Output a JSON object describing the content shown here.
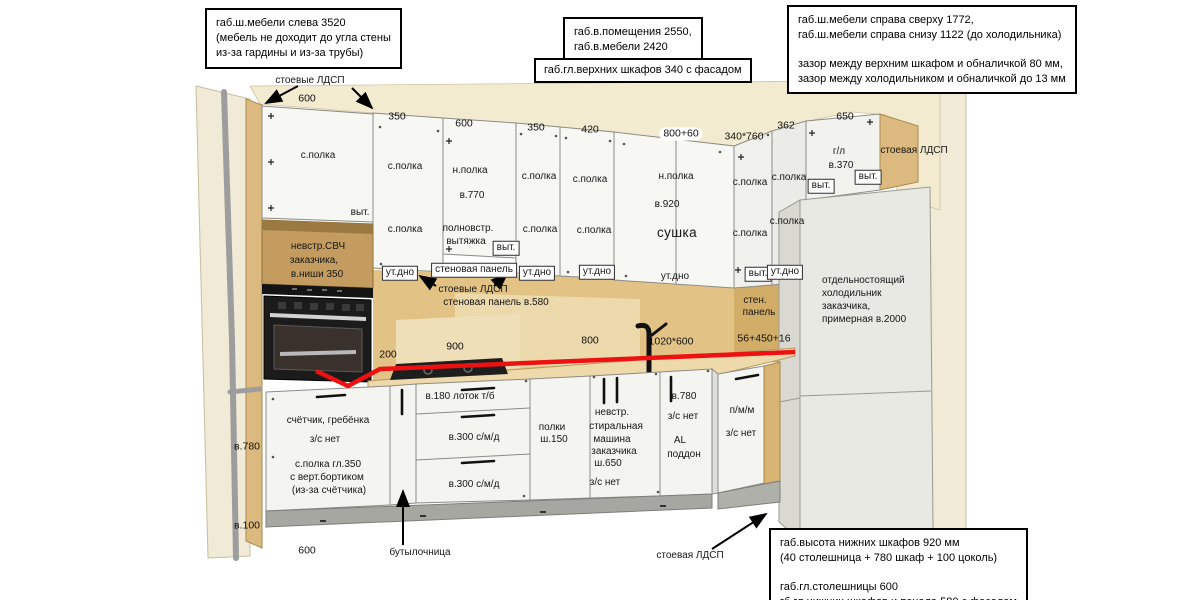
{
  "callouts": {
    "top_left": {
      "lines": [
        "габ.ш.мебели слева 3520",
        "(мебель не доходит до угла стены",
        "из-за гардины и из-за трубы)"
      ]
    },
    "room": {
      "lines": [
        "габ.в.помещения 2550,",
        "габ.в.мебели 2420"
      ]
    },
    "upper_depth": {
      "lines": [
        "габ.гл.верхних шкафов 340 с фасадом"
      ]
    },
    "top_right": {
      "lines": [
        "габ.ш.мебели справа сверху 1772,",
        "габ.ш.мебели справа снизу 1122 (до холодильника)",
        "",
        "зазор между верхним шкафом и обналичкой 80 мм,",
        "зазор между холодильником и обналичкой до 13 мм"
      ]
    },
    "bottom_right": {
      "lines": [
        "габ.высота нижних шкафов 920 мм",
        "(40 столешница + 780 шкаф + 100 цоколь)",
        "",
        "габ.гл.столешницы 600",
        "гб.гл.нижних шкафов и пенала 580 с фасадом"
      ]
    }
  },
  "dims_top": [
    "600",
    "350",
    "600",
    "350",
    "420",
    "800+60",
    "340*760",
    "362",
    "650"
  ],
  "dims_other": {
    "d200": "200",
    "d900": "900",
    "d800": "800",
    "d1020": "1020*600",
    "d56": "56+450+16",
    "v780": "в.780",
    "v100": "в.100",
    "b600": "600"
  },
  "upper": {
    "ldsp_top": "стоевые ЛДСП",
    "cab1_shelf": "с.полка",
    "cab1_vyt": "выт.",
    "micro1": "невстр.СВЧ",
    "micro2": "заказчика,",
    "micro3": "в.ниши 350",
    "cab2_shelf1": "с.полка",
    "cab2_shelf2": "с.полка",
    "cab2_utdno": "ут.дно",
    "cab3_npolka": "н.полка",
    "cab3_h": "в.770",
    "cab3_hood1": "полновстр.",
    "cab3_hood2": "вытяжка",
    "cab3_vyt": "выт.",
    "wallpanel_box": "стеновая панель",
    "ldsp_mid": "стоевые ЛДСП",
    "wallpanel580": "стеновая панель в.580",
    "cab4_shelf1": "с.полка",
    "cab4_shelf2": "с.полка",
    "cab4_utdno": "ут.дно",
    "cab5_shelf1": "с.полка",
    "cab5_shelf2": "с.полка",
    "cab5_utdno": "ут.дно",
    "cab6_npolka": "н.полка",
    "cab6_h": "в.920",
    "cab6_sushka": "сушка",
    "cab6_utdno": "ут.дно",
    "cab7_shelf1": "с.полка",
    "cab7_shelf2": "с.полка",
    "cab7_vyt": "выт.",
    "cab8_shelf1": "с.полка",
    "cab8_shelf2": "с.полка",
    "cab8_utdno": "ут.дно",
    "cab9_gl": "г/л",
    "cab9_h": "в.370",
    "cab9_vyt1": "выт.",
    "cab9_vyt2": "выт.",
    "ldsp_right": "стоевая ЛДСП",
    "sten1": "стен.",
    "sten2": "панель"
  },
  "fridge": {
    "l1": "отдельностоящий",
    "l2": "холодильник",
    "l3": "заказчика,",
    "l4": "примерная в.2000"
  },
  "lower": {
    "meter1": "счётчик, гребёнка",
    "meter2": "з/с нет",
    "meter3": "с.полка гл.350",
    "meter4": "с верт.бортиком",
    "meter5": "(из-за счётчика)",
    "tray": "в.180 лоток т/б",
    "smd1": "в.300 с/м/д",
    "smd2": "в.300 с/м/д",
    "bottle": "бутылочница",
    "shelves1": "полки",
    "shelves2": "ш.150",
    "wash1": "невстр.",
    "wash2": "стиральная",
    "wash3": "машина",
    "wash4": "заказчика",
    "wash5": "ш.650",
    "wash_zs": "з/с нет",
    "sink_h": "в.780",
    "sink_zs": "з/с нет",
    "sink_al": "AL",
    "sink_pod": "поддон",
    "pmm": "п/м/м",
    "pmm_zs": "з/с нет",
    "ldsp_bottom": "стоевая ЛДСП"
  }
}
